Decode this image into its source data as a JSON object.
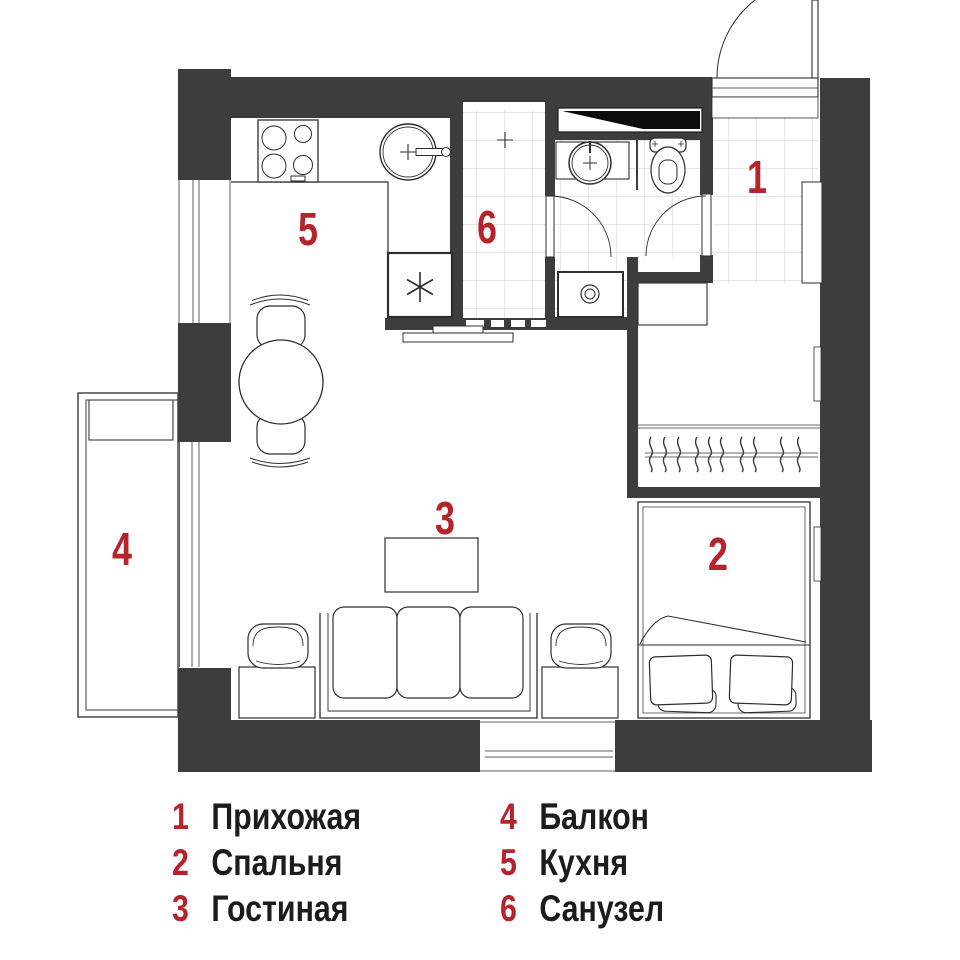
{
  "floor_plan": {
    "wall_color": "#3d3d3d",
    "marker_color": "#b6242b",
    "room_markers": [
      {
        "number": "1",
        "room": "Прихожая"
      },
      {
        "number": "2",
        "room": "Спальня"
      },
      {
        "number": "3",
        "room": "Гостиная"
      },
      {
        "number": "4",
        "room": "Балкон"
      },
      {
        "number": "5",
        "room": "Кухня"
      },
      {
        "number": "6",
        "room": "Санузел"
      }
    ],
    "icons": [
      "stove-icon",
      "kitchen-sink-icon",
      "refrigerator-icon",
      "dining-table-icon",
      "chair-icon",
      "sofa-icon",
      "coffee-table-icon",
      "side-table-icon",
      "pouf-icon",
      "bed-icon",
      "pillow-icon",
      "wardrobe-hangers-icon",
      "bathroom-sink-icon",
      "toilet-icon",
      "washing-machine-icon",
      "shower-drain-icon",
      "vent-shaft-icon",
      "entry-door-icon",
      "interior-door-icon",
      "sliding-door-icon",
      "balcony-bench-icon"
    ]
  },
  "legend": {
    "number_color": "#b6242b",
    "text_color": "#1c1c1c",
    "columns": [
      {
        "items": [
          {
            "number": "1",
            "label": "Прихожая"
          },
          {
            "number": "2",
            "label": "Спальня"
          },
          {
            "number": "3",
            "label": "Гостиная"
          }
        ]
      },
      {
        "items": [
          {
            "number": "4",
            "label": "Балкон"
          },
          {
            "number": "5",
            "label": "Кухня"
          },
          {
            "number": "6",
            "label": "Санузел"
          }
        ]
      }
    ]
  }
}
